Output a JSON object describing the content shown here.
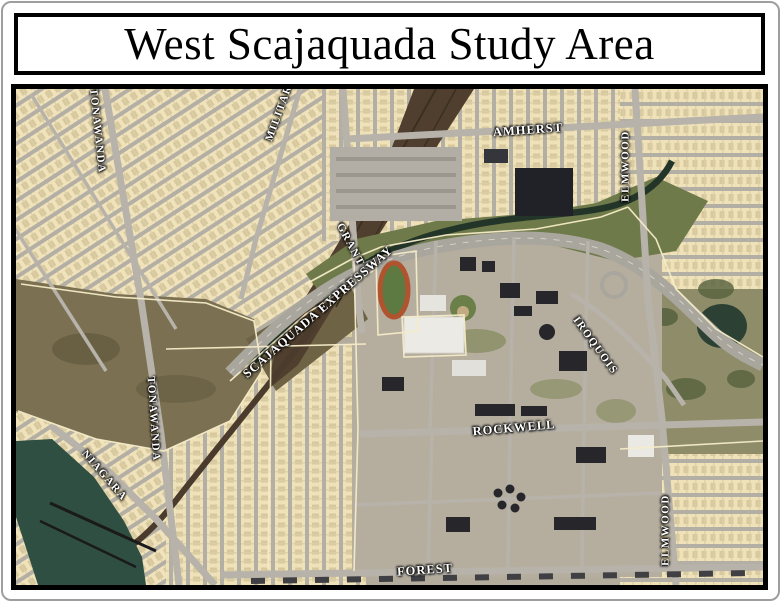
{
  "page": {
    "title": "West Scajaquada Study Area"
  },
  "map": {
    "labels": [
      {
        "id": "military",
        "text": "MILITARY"
      },
      {
        "id": "tonawanda-north",
        "text": "TONAWANDA"
      },
      {
        "id": "amherst",
        "text": "AMHERST"
      },
      {
        "id": "elmwood-north",
        "text": "ELMWOOD"
      },
      {
        "id": "grant",
        "text": "GRANT"
      },
      {
        "id": "scajaquada-expressway",
        "text": "SCAJAQUADA EXPRESSWAY"
      },
      {
        "id": "iroquois",
        "text": "IROQUOIS"
      },
      {
        "id": "tonawanda-south",
        "text": "TONAWANDA"
      },
      {
        "id": "rockwell",
        "text": "ROCKWELL"
      },
      {
        "id": "niagara",
        "text": "NIAGARA"
      },
      {
        "id": "forest",
        "text": "FOREST"
      },
      {
        "id": "elmwood-south",
        "text": "ELMWOOD"
      }
    ],
    "colors": {
      "parcel_fill": "#f0e2ba",
      "parcel_line": "#f6ecc8",
      "road_gray": "#b7b3aa",
      "water": "#2f4f42",
      "creek": "#233528",
      "rail_brown": "#4f3f2e",
      "wetland": "#7b7152",
      "grass_bank": "#6f7a4a",
      "park": "#8f8c6a",
      "building_dark": "#26262b",
      "building_light": "#eceae4",
      "track_orange": "#b0532f",
      "field_green": "#5d7a42",
      "label_text": "#ffffff",
      "label_halo": "#000000",
      "map_border": "#000000",
      "page_border": "#9e9e9e",
      "base_ground": "#b3ac9d"
    }
  }
}
